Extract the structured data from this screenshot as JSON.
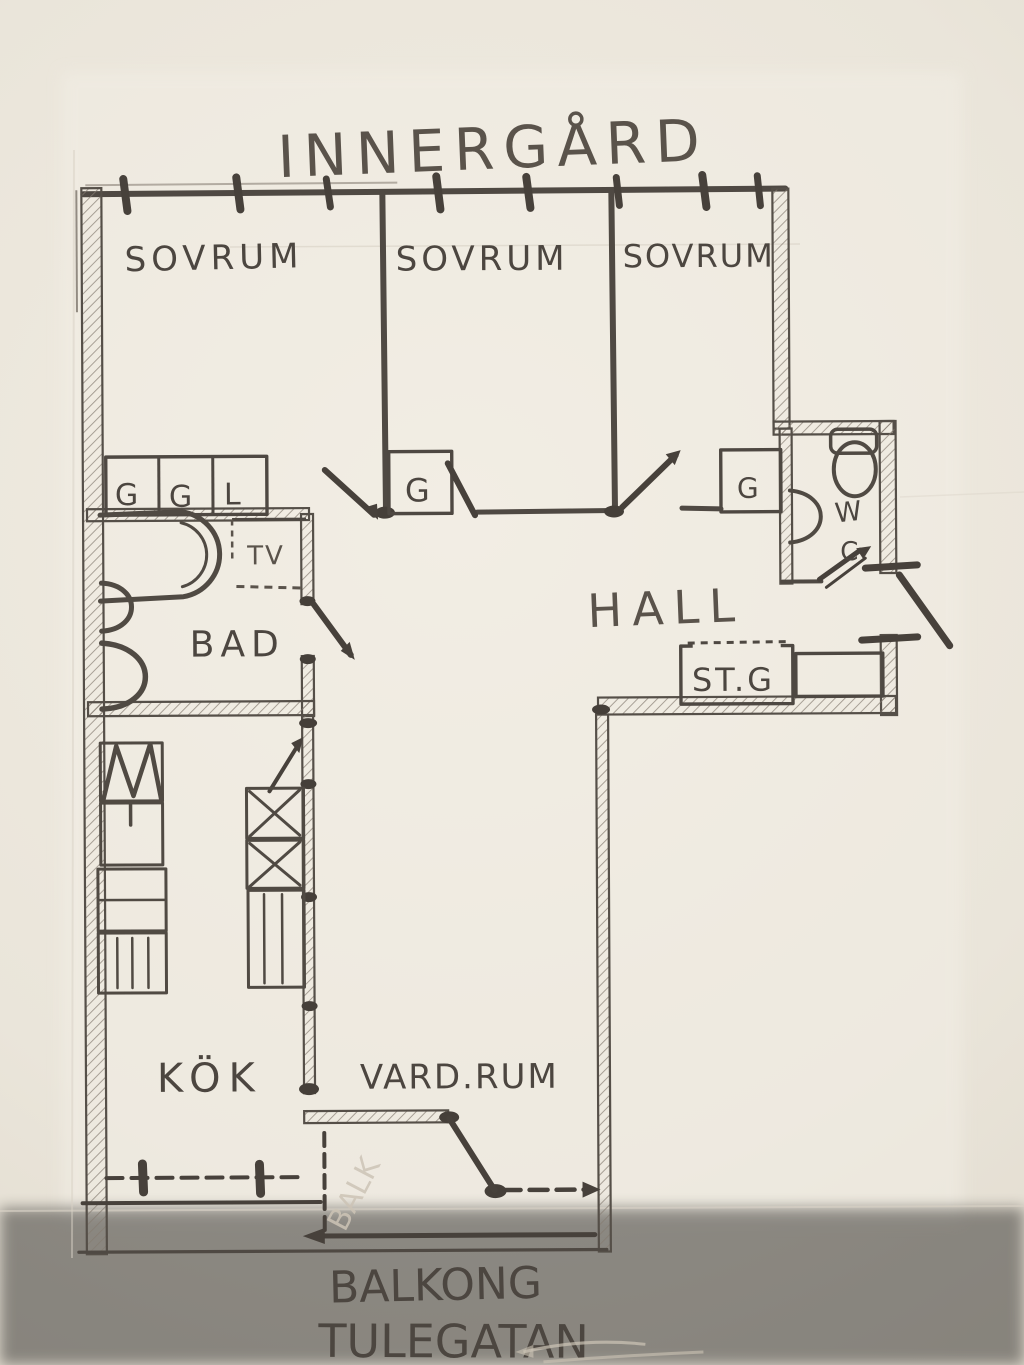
{
  "labels": {
    "title": "INNERGÅRD",
    "bedroom1": "SOVRUM",
    "bedroom2": "SOVRUM",
    "bedroom3": "SOVRUM",
    "hall": "HALL",
    "bathroom": "BAD",
    "kitchen": "KÖK",
    "living_room": "VARD.RUM",
    "balcony": "BALKONG",
    "street": "TULEGATAN",
    "wc_letter_top": "W",
    "wc_letter_bottom": "C",
    "washer": "TV",
    "storage_closet": "ST.G",
    "closet_row": [
      "G",
      "G",
      "L"
    ],
    "bedroom2_closet": "G",
    "bedroom3_closet": "G",
    "balcony_faint_note": "BALK"
  },
  "colors": {
    "paper": "#eae5da",
    "sheet": "#f2eee5",
    "ink": "#46403a",
    "pencil": "#6b635a",
    "faint": "#cdc4b6"
  }
}
